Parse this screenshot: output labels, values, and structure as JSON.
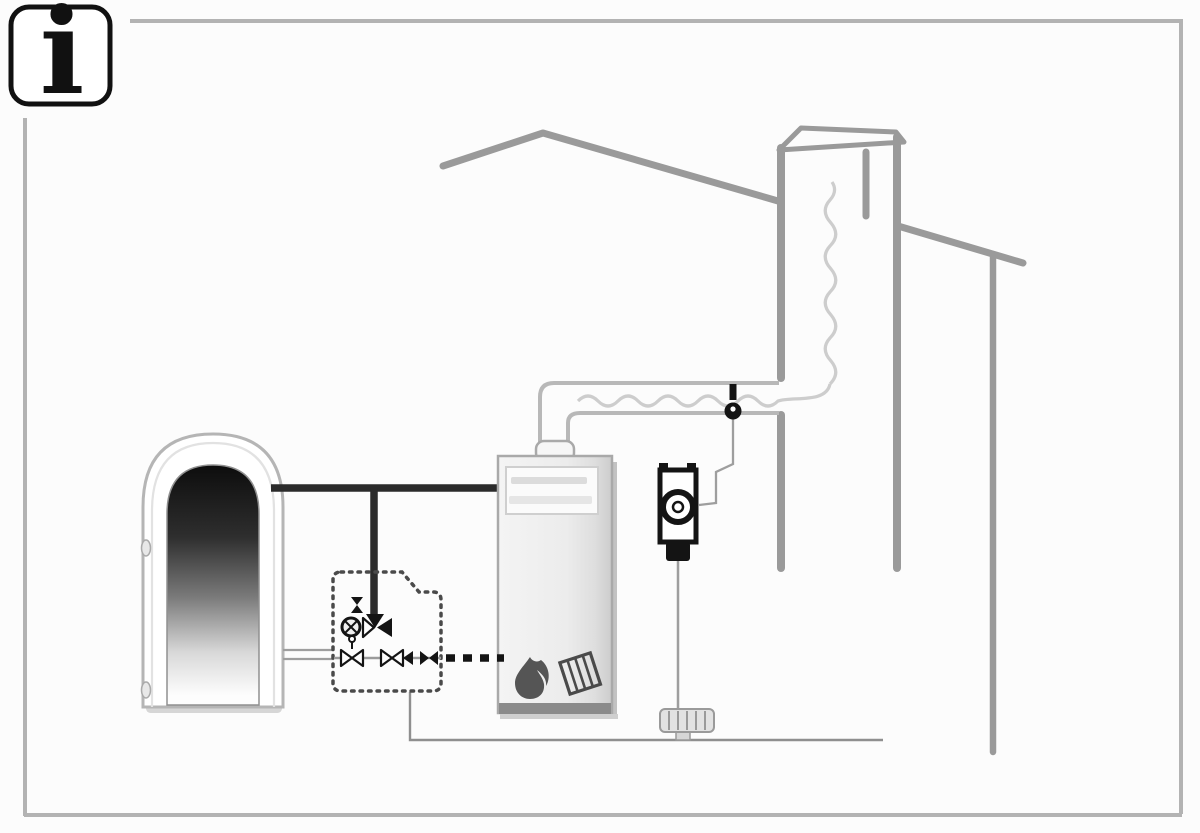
{
  "info_badge": {
    "symbol": "i"
  },
  "palette": {
    "bg": "#fcfcfc",
    "frame": "#b3b3b3",
    "house": "#9a9a9a",
    "flue": "#b8b8b8",
    "liner": "#cdcdcd",
    "pipe": "#2b2b2b",
    "thin": "#9e9e9e",
    "dark": "#141414",
    "icon": "#4a4a4a",
    "tankStroke": "#b5b5b5",
    "boilerEdge": "#a9a9a9"
  },
  "diagram": {
    "kind": "heating-system-installation-schematic",
    "components": [
      "info-badge",
      "picture-frame-border",
      "house-roof-left",
      "house-roof-right",
      "house-wall-right",
      "chimney-shaft",
      "chimney-top-opening",
      "flexible-flue-liner",
      "flue-duct",
      "flue-gas-sensor",
      "sensor-cable",
      "circulation-pump",
      "draft-regulator-fitting",
      "hot-water-storage-tank",
      "tank-connection-stubs",
      "supply-pipe-thick",
      "return-pipes-thin",
      "mixing-valve-assembly",
      "valve-enclosure-dashed-box",
      "wood-boiler",
      "boiler-control-panel",
      "flame-icon",
      "wood-logs-icon",
      "boiler-dashed-connection",
      "ground-connection-line"
    ]
  }
}
